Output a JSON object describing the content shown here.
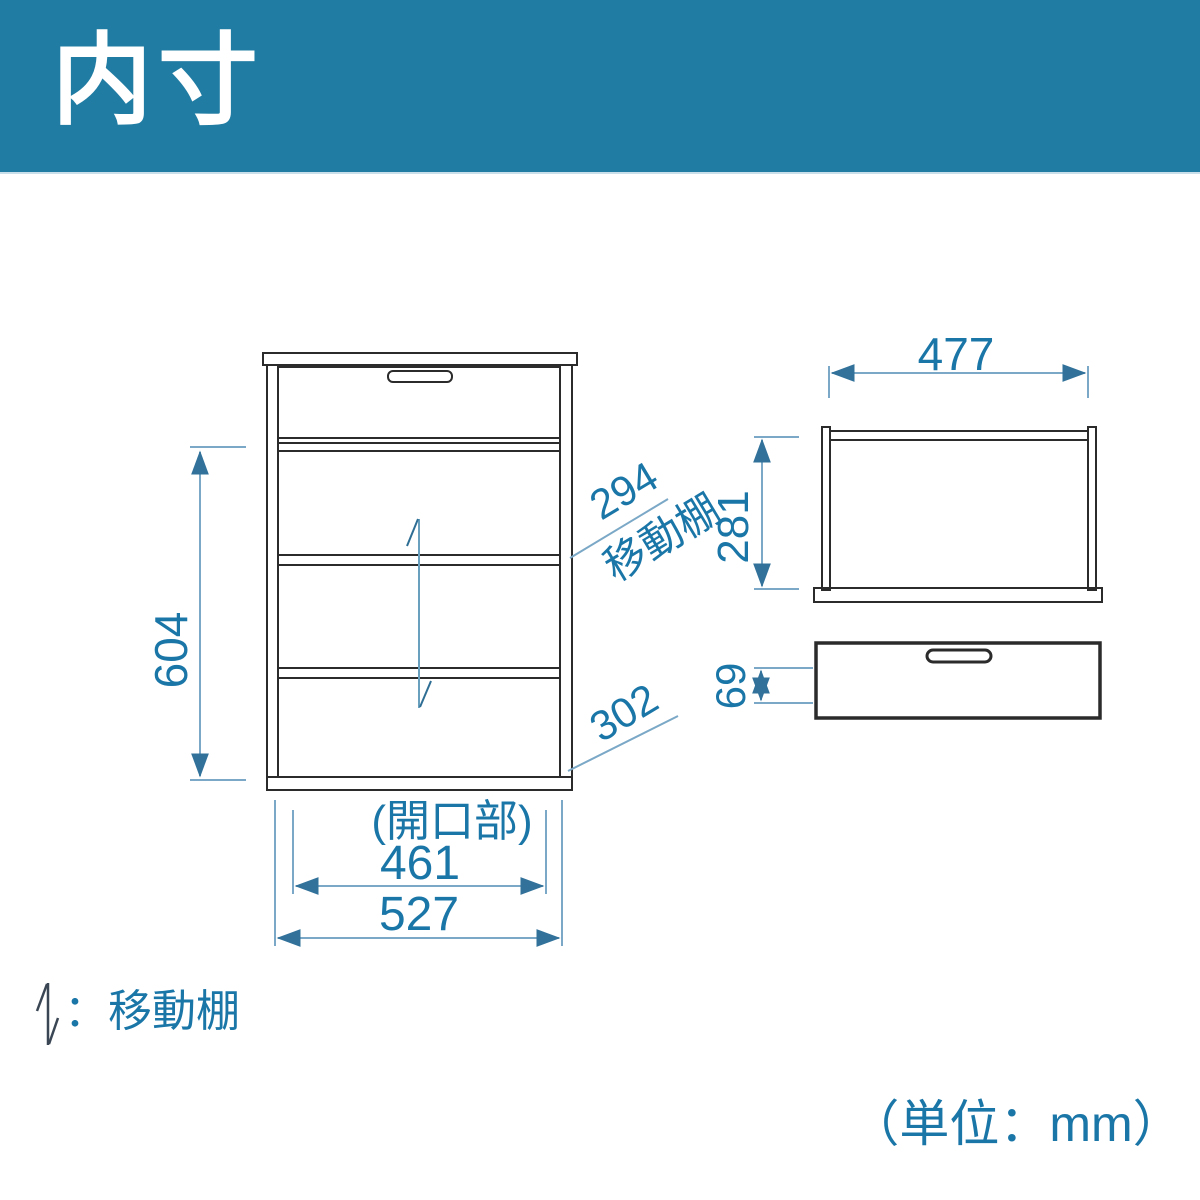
{
  "header": {
    "title": "内寸",
    "bg_color": "#207CA3",
    "text_color": "#FFFFFF"
  },
  "diagram": {
    "type": "furniture-internal-dimension-drawing",
    "unit_note": "（単位：mm）",
    "legend": {
      "symbol": "movable-shelf-arrow",
      "label": "：移動棚"
    },
    "colors": {
      "outline": "#2B2B2B",
      "dimension_text": "#1B76A8",
      "dimension_line": "#7AA8C6",
      "arrowhead": "#31719A",
      "legend_icon": "#3A4654"
    },
    "front_view": {
      "description": "cabinet front elevation with drawer on top and three shelf openings",
      "dimensions": {
        "inner_height": "604",
        "upper_opening_height": "294",
        "upper_opening_note": "移動棚",
        "lower_opening_height": "302",
        "opening_label": "(開口部)",
        "opening_width": "461",
        "inner_width": "527"
      }
    },
    "back_frame_view": {
      "description": "open frame section seen from behind",
      "dimensions": {
        "inner_width": "477",
        "inner_height": "281"
      }
    },
    "drawer_view": {
      "description": "drawer box with handle slot",
      "dimensions": {
        "inner_height": "69"
      }
    }
  }
}
